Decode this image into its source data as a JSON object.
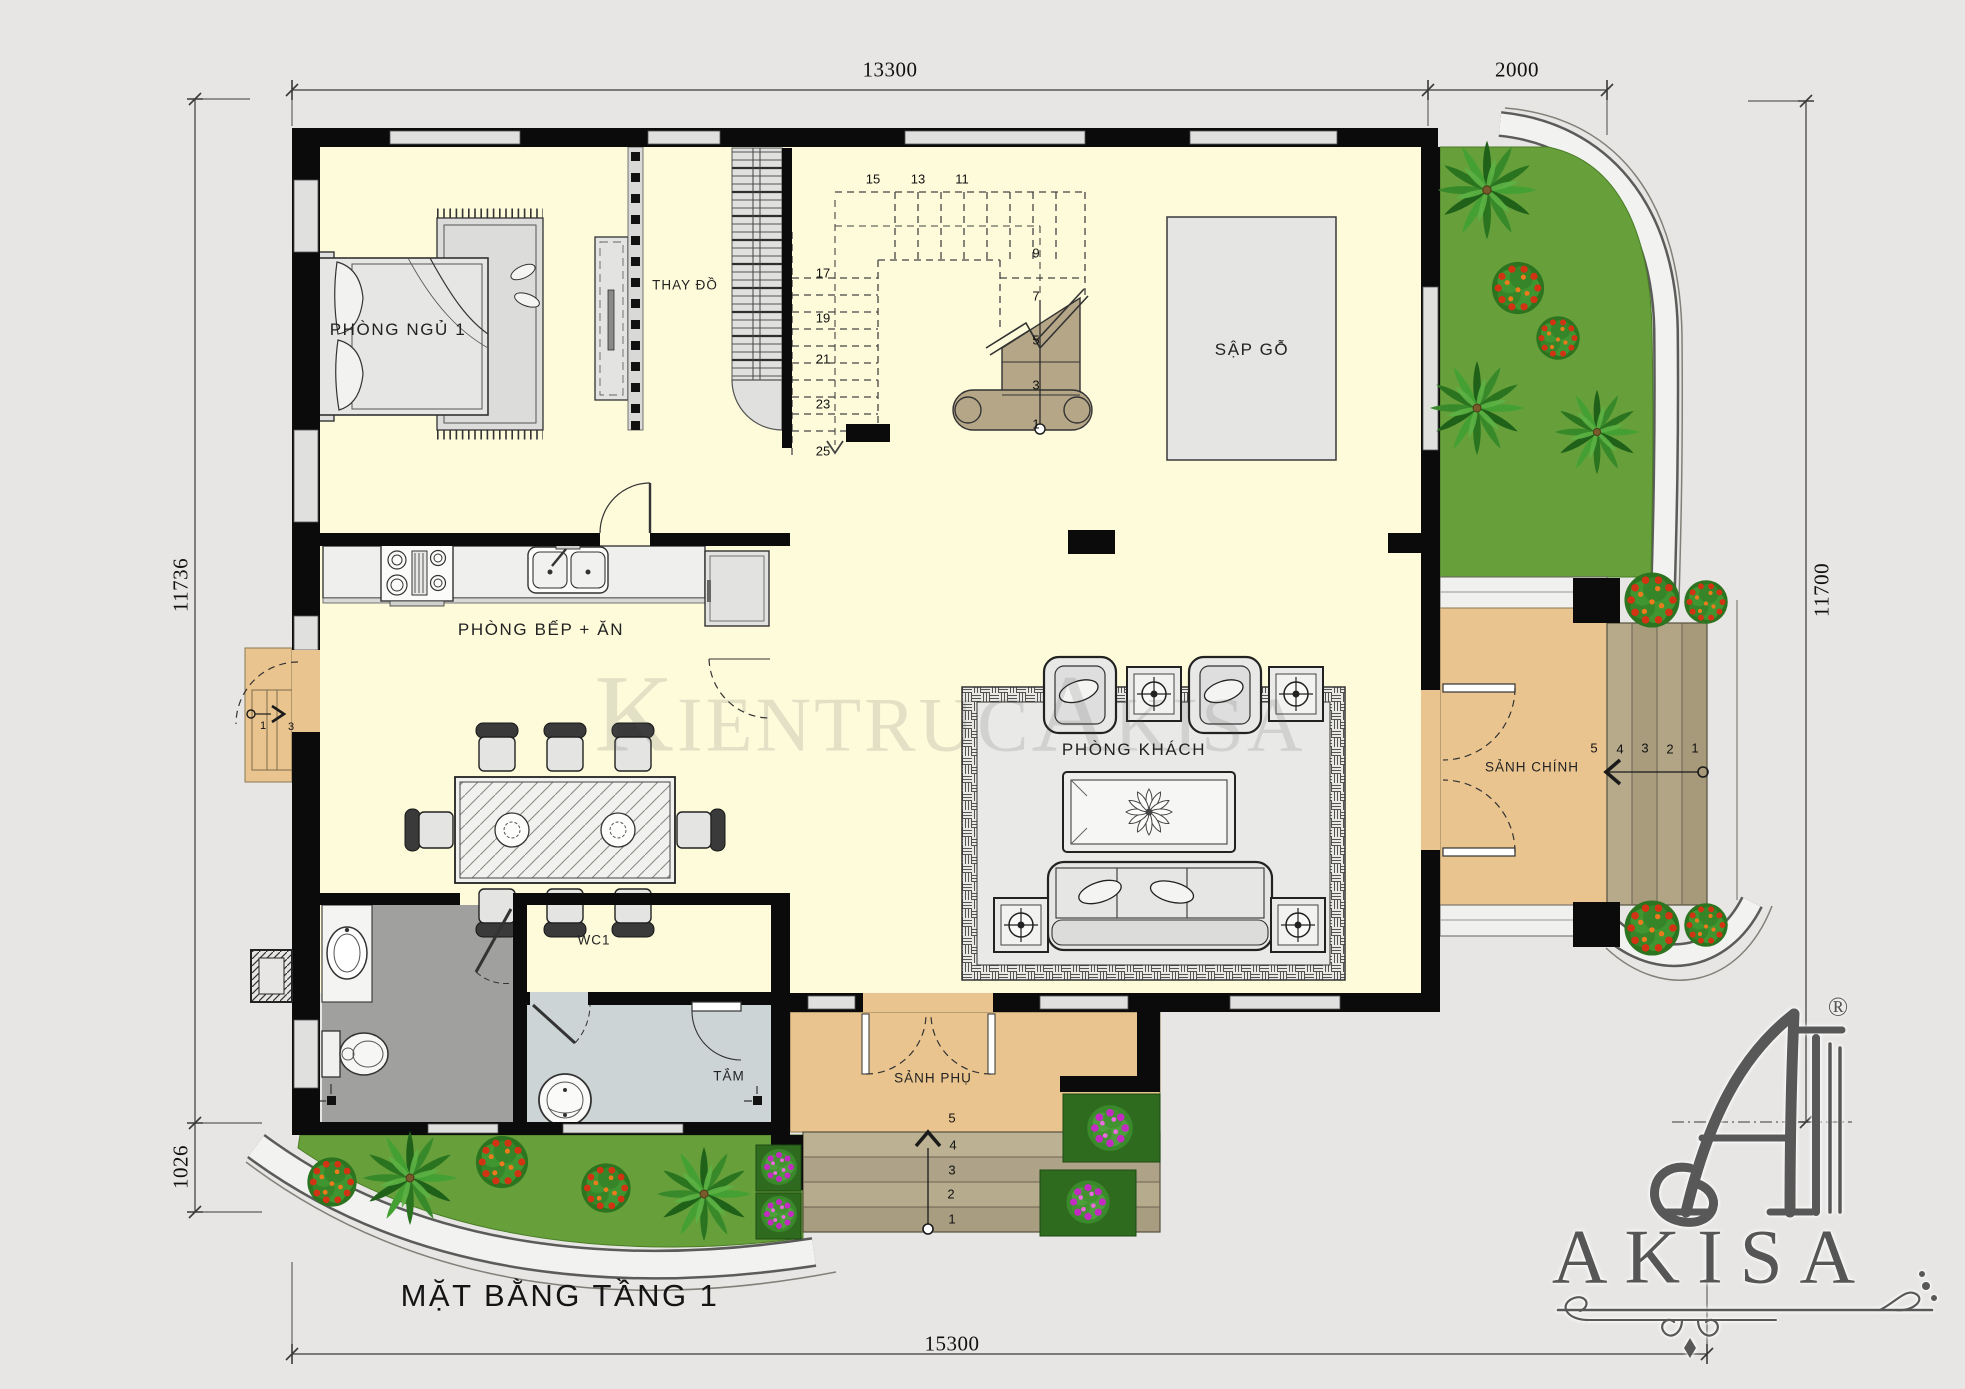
{
  "title": "MẶT BẰNG TẦNG 1",
  "watermark": "KientrucAkisa",
  "brand": {
    "name": "AKISA",
    "reg": "®"
  },
  "dimensions": {
    "top": "13300",
    "top_right": "2000",
    "left": "11736",
    "left_bottom": "1026",
    "right": "11700",
    "bottom": "15300"
  },
  "rooms": {
    "bedroom": "PHÒNG NGỦ 1",
    "dressing": "THAY ĐỒ",
    "wood_bed": "SẬP GỖ",
    "kitchen": "PHÒNG BẾP + ĂN",
    "living": "PHÒNG KHÁCH",
    "main_hall": "SẢNH CHÍNH",
    "wc": "WC1",
    "bath": "TẮM",
    "side_hall": "SẢNH PHỤ"
  },
  "stairs": {
    "top_run": [
      "15",
      "13",
      "11"
    ],
    "left_run": [
      "17",
      "19",
      "21",
      "23",
      "25"
    ],
    "right_run": [
      "9",
      "7",
      "5",
      "3",
      "1"
    ],
    "main_entry_steps": [
      "5",
      "4",
      "3",
      "2",
      "1"
    ],
    "side_entry_steps": [
      "5",
      "4",
      "3",
      "2",
      "1"
    ],
    "west_entry_steps": [
      "1",
      "3"
    ]
  },
  "colors": {
    "wall": "#0b0b0b",
    "floor": "#fdfbda",
    "porch_tan": "#e9c48f",
    "step_brown": "#b0a383",
    "lawn_green": "#67a03a",
    "bath_gray": "#a0a09e",
    "bath_blue": "#ccd4d6",
    "stair_wood": "#b5a687",
    "logo_gray": "#565656"
  }
}
